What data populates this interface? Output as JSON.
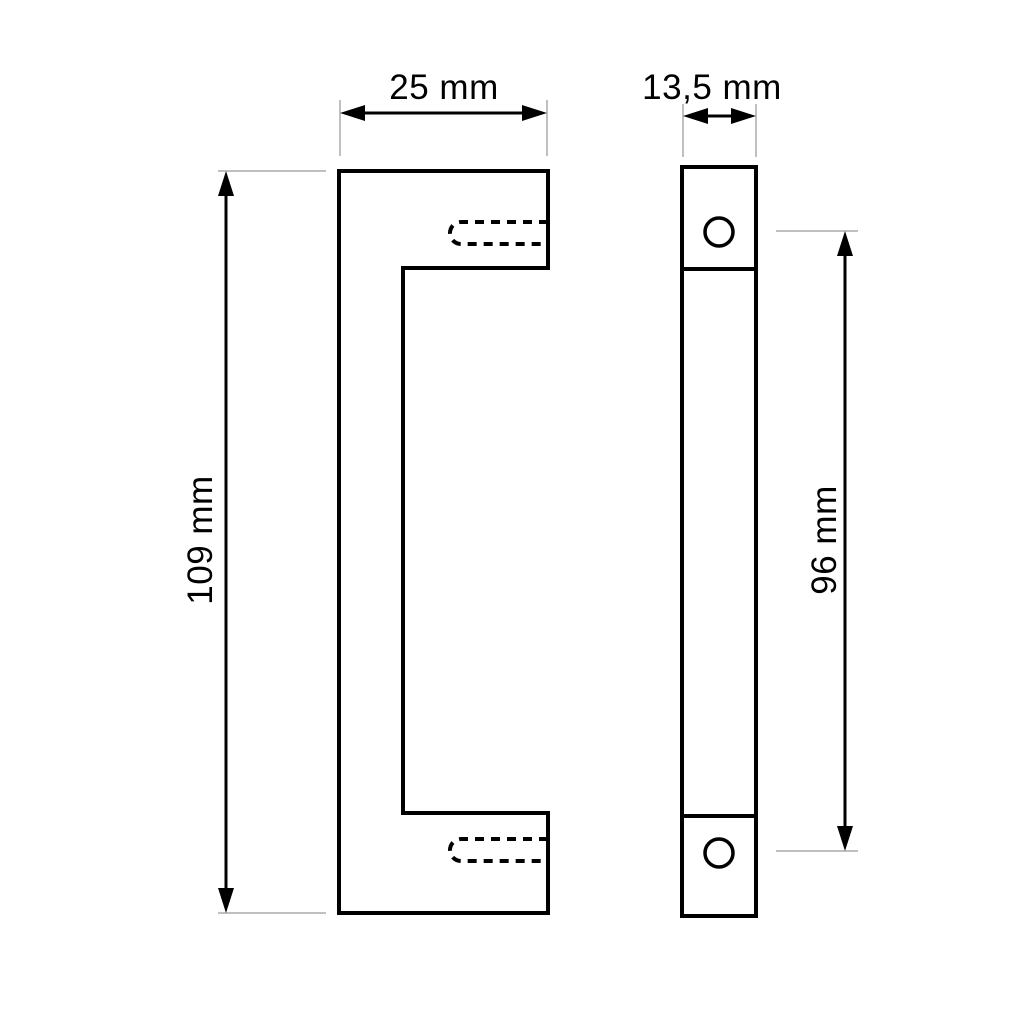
{
  "drawing": {
    "type": "technical-dimension-drawing",
    "views": {
      "front_view": "handle-front-profile",
      "side_view": "handle-side-profile"
    },
    "labels": {
      "front_width": "25 mm",
      "side_width": "13,5 mm",
      "front_height": "109 mm",
      "hole_spacing": "96 mm"
    },
    "colors": {
      "line": "#000000",
      "extension_line": "#c0c0c0",
      "background": "#ffffff",
      "text": "#000000"
    }
  }
}
